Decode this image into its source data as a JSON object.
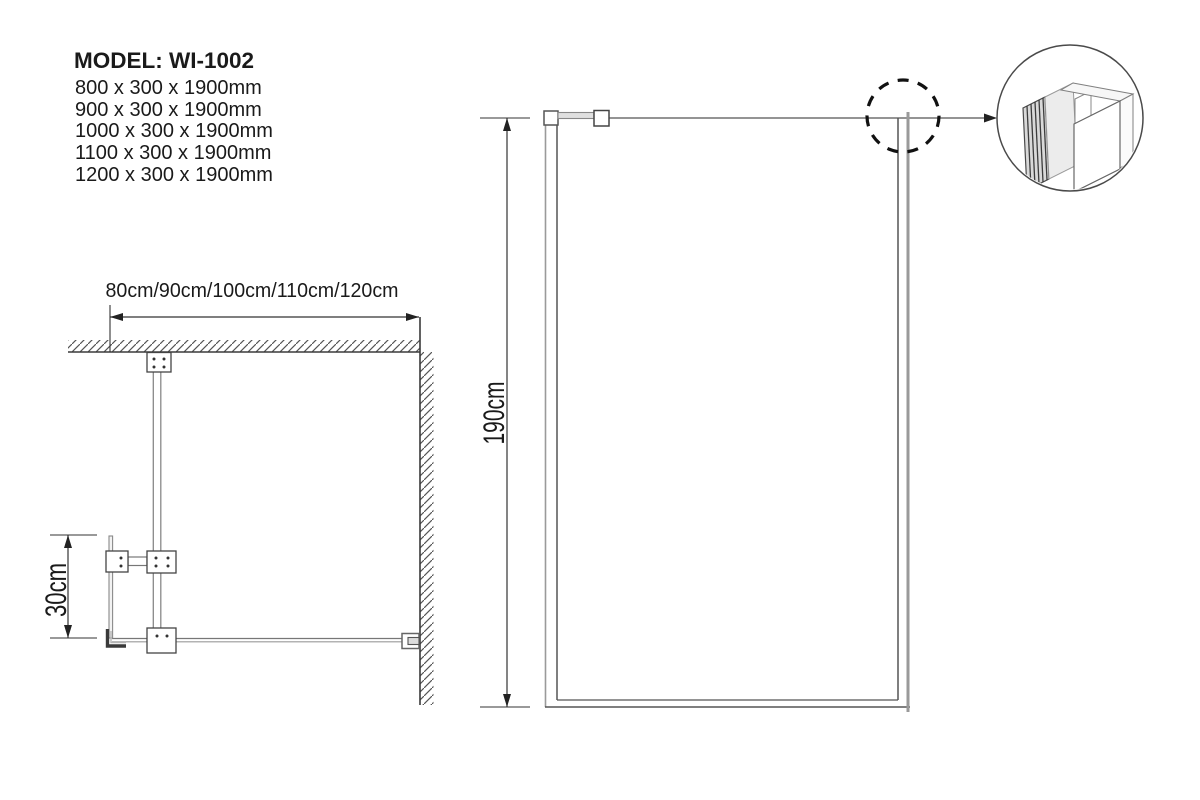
{
  "header": {
    "model_label": "MODEL: WI-1002"
  },
  "size_options": [
    "800 x 300 x 1900mm",
    "900 x 300 x 1900mm",
    "1000 x 300 x 1900mm",
    "1100 x 300 x 1900mm",
    "1200 x 300 x 1900mm"
  ],
  "plan_view": {
    "width_label": "80cm/90cm/100cm/110cm/120cm",
    "return_depth_label": "30cm"
  },
  "front_view": {
    "height_label": "190cm"
  },
  "colors": {
    "line_dark": "#3a3a3a",
    "line_gray": "#999999",
    "hatch": "#555555",
    "text": "#1a1a1a"
  }
}
